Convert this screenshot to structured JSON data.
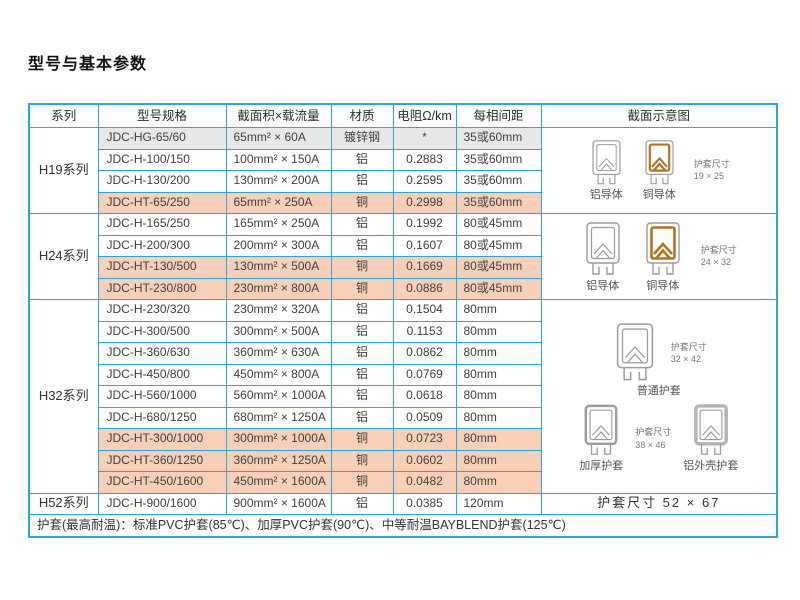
{
  "page": {
    "title": "型号与基本参数"
  },
  "colors": {
    "table_border": "#2ba7e0",
    "pink_row": "#f7d0b7",
    "gray_row": "#e8e8e8",
    "copper": "#b5731e",
    "profile_gray": "#9c9c9c"
  },
  "table": {
    "headers": [
      "系列",
      "型号规格",
      "截面积×载流量",
      "材质",
      "电阻Ω/km",
      "每相间距",
      "截面示意图"
    ],
    "groups": [
      {
        "series": "H19系列",
        "rows": [
          {
            "model": "JDC-HG-65/60",
            "spec": "65mm² × 60A",
            "material": "镀锌钢",
            "resistance": "*",
            "spacing": "35或60mm",
            "style": "gray"
          },
          {
            "model": "JDC-H-100/150",
            "spec": "100mm² × 150A",
            "material": "铝",
            "resistance": "0.2883",
            "spacing": "35或60mm",
            "style": ""
          },
          {
            "model": "JDC-H-130/200",
            "spec": "130mm² × 200A",
            "material": "铝",
            "resistance": "0.2595",
            "spacing": "35或60mm",
            "style": ""
          },
          {
            "model": "JDC-HT-65/250",
            "spec": "65mm² × 250A",
            "material": "铜",
            "resistance": "0.2998",
            "spacing": "35或60mm",
            "style": "pink"
          }
        ],
        "diagram": {
          "kind": "pair",
          "items": [
            {
              "icon": "aluminum",
              "label": "铝导体"
            },
            {
              "icon": "copper",
              "label": "铜导体"
            }
          ],
          "dim": {
            "label": "护套尺寸",
            "size": "19 × 25"
          }
        }
      },
      {
        "series": "H24系列",
        "rows": [
          {
            "model": "JDC-H-165/250",
            "spec": "165mm² × 250A",
            "material": "铝",
            "resistance": "0.1992",
            "spacing": "80或45mm",
            "style": ""
          },
          {
            "model": "JDC-H-200/300",
            "spec": "200mm² × 300A",
            "material": "铝",
            "resistance": "0.1607",
            "spacing": "80或45mm",
            "style": ""
          },
          {
            "model": "JDC-HT-130/500",
            "spec": "130mm² × 500A",
            "material": "铜",
            "resistance": "0.1669",
            "spacing": "80或45mm",
            "style": "pink"
          },
          {
            "model": "JDC-HT-230/800",
            "spec": "230mm² × 800A",
            "material": "铜",
            "resistance": "0.0886",
            "spacing": "80或45mm",
            "style": "pink"
          }
        ],
        "diagram": {
          "kind": "pair",
          "items": [
            {
              "icon": "aluminum",
              "label": "铝导体"
            },
            {
              "icon": "copper",
              "label": "铜导体"
            }
          ],
          "dim": {
            "label": "护套尺寸",
            "size": "24 × 32"
          }
        }
      },
      {
        "series": "H32系列",
        "rows": [
          {
            "model": "JDC-H-230/320",
            "spec": "230mm² × 320A",
            "material": "铝",
            "resistance": "0.1504",
            "spacing": "80mm",
            "style": ""
          },
          {
            "model": "JDC-H-300/500",
            "spec": "300mm² × 500A",
            "material": "铝",
            "resistance": "0.1153",
            "spacing": "80mm",
            "style": ""
          },
          {
            "model": "JDC-H-360/630",
            "spec": "360mm² × 630A",
            "material": "铝",
            "resistance": "0.0862",
            "spacing": "80mm",
            "style": ""
          },
          {
            "model": "JDC-H-450/800",
            "spec": "450mm² × 800A",
            "material": "铝",
            "resistance": "0.0769",
            "spacing": "80mm",
            "style": ""
          },
          {
            "model": "JDC-H-560/1000",
            "spec": "560mm² × 1000A",
            "material": "铝",
            "resistance": "0.0618",
            "spacing": "80mm",
            "style": ""
          },
          {
            "model": "JDC-H-680/1250",
            "spec": "680mm² × 1250A",
            "material": "铝",
            "resistance": "0.0509",
            "spacing": "80mm",
            "style": ""
          },
          {
            "model": "JDC-HT-300/1000",
            "spec": "300mm² × 1000A",
            "material": "铜",
            "resistance": "0.0723",
            "spacing": "80mm",
            "style": "pink"
          },
          {
            "model": "JDC-HT-360/1250",
            "spec": "360mm² × 1250A",
            "material": "铜",
            "resistance": "0.0602",
            "spacing": "80mm",
            "style": "pink"
          },
          {
            "model": "JDC-HT-450/1600",
            "spec": "450mm² × 1600A",
            "material": "铜",
            "resistance": "0.0482",
            "spacing": "80mm",
            "style": "pink"
          }
        ],
        "diagram": {
          "kind": "h32",
          "top": {
            "icon": "normal",
            "label": "普通护套",
            "dim": {
              "label": "护套尺寸",
              "size": "32 × 42"
            }
          },
          "bottom": {
            "left": {
              "icon": "thick",
              "label": "加厚护套"
            },
            "right": {
              "icon": "shell",
              "label": "铝外壳护套"
            },
            "dim": {
              "label": "护套尺寸",
              "size": "38 × 46"
            }
          }
        }
      },
      {
        "series": "H52系列",
        "rows": [
          {
            "model": "JDC-H-900/1600",
            "spec": "900mm² × 1600A",
            "material": "铝",
            "resistance": "0.0385",
            "spacing": "120mm",
            "style": ""
          }
        ],
        "diagram": {
          "kind": "text",
          "text": "护套尺寸  52 × 67"
        }
      }
    ],
    "footer": "护套(最高耐温)：标准PVC护套(85℃)、加厚PVC护套(90℃)、中等耐温BAYBLEND护套(125℃)"
  }
}
